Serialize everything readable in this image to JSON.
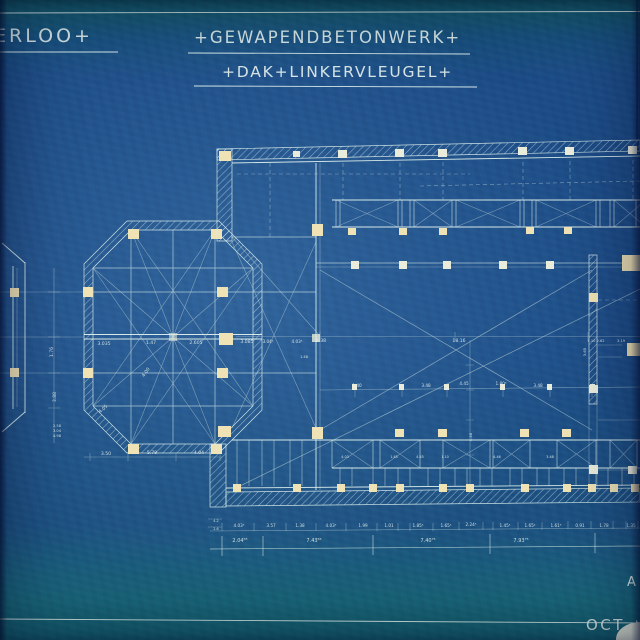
{
  "title_block": {
    "location_fragment": "ERLOO+",
    "subject": "+GEWAPENDBETONWERK+",
    "sheet": "+DAK+LINKERVLEUGEL+"
  },
  "footer": {
    "date_fragment": "OCT.+",
    "signature_fragment": "A"
  },
  "colors": {
    "paper_blue": "#1d4e88",
    "teal_edge": "#155a70",
    "ink": "#e4f1ee",
    "column_fill": "#efe2b4"
  },
  "annotations": [
    {
      "t": "3.035",
      "x": 104,
      "y": 345
    },
    {
      "t": "1.47",
      "x": 151,
      "y": 344
    },
    {
      "t": "2.605",
      "x": 196,
      "y": 344
    },
    {
      "t": "3.085",
      "x": 247,
      "y": 343
    },
    {
      "t": "4.00",
      "x": 147,
      "y": 373,
      "r": -55
    },
    {
      "t": "4.05",
      "x": 104,
      "y": 410,
      "r": -42
    },
    {
      "t": "3.50",
      "x": 106,
      "y": 455
    },
    {
      "t": "5.78",
      "x": 152,
      "y": 454
    },
    {
      "t": "4.04",
      "x": 199,
      "y": 454
    },
    {
      "t": "1.76",
      "x": 53,
      "y": 352,
      "r": -90
    },
    {
      "t": "3.88",
      "x": 56,
      "y": 397,
      "r": -90
    },
    {
      "t": "2.58",
      "x": 57,
      "y": 427,
      "s": 3.6
    },
    {
      "t": "3.04",
      "x": 57,
      "y": 432,
      "s": 3.6
    },
    {
      "t": "4.98",
      "x": 57,
      "y": 437,
      "s": 3.6
    },
    {
      "t": "3.04⁵",
      "x": 268,
      "y": 343,
      "s": 4.2
    },
    {
      "t": "4.03⁵",
      "x": 297,
      "y": 343,
      "s": 4.2
    },
    {
      "t": "8.38",
      "x": 321,
      "y": 342
    },
    {
      "t": "1.48",
      "x": 304,
      "y": 358,
      "s": 3.6
    },
    {
      "t": "18.16",
      "x": 459,
      "y": 342
    },
    {
      "t": "1.10 2.62",
      "x": 596,
      "y": 342,
      "s": 3.6
    },
    {
      "t": "3.19",
      "x": 621,
      "y": 342,
      "s": 3.6
    },
    {
      "t": "1.40",
      "x": 357,
      "y": 387,
      "s": 4.2
    },
    {
      "t": "3.48",
      "x": 426,
      "y": 387,
      "s": 4.2
    },
    {
      "t": "4.45",
      "x": 464,
      "y": 385,
      "s": 4.2
    },
    {
      "t": "1.80⁵",
      "x": 501,
      "y": 385,
      "s": 4.2
    },
    {
      "t": "3.48",
      "x": 538,
      "y": 387,
      "s": 4.2
    },
    {
      "t": "4.48",
      "x": 472,
      "y": 437,
      "r": -90,
      "s": 3.8
    },
    {
      "t": "3.65",
      "x": 586,
      "y": 352,
      "r": -90,
      "s": 3.8
    },
    {
      "t": "4.03",
      "x": 345,
      "y": 458,
      "s": 3.4
    },
    {
      "t": "1.45",
      "x": 394,
      "y": 458,
      "s": 3.4
    },
    {
      "t": "4.45",
      "x": 420,
      "y": 458,
      "s": 3.4
    },
    {
      "t": "1.10",
      "x": 445,
      "y": 458,
      "s": 3.4
    },
    {
      "t": "4.46",
      "x": 497,
      "y": 458,
      "s": 3.4
    },
    {
      "t": "3.48",
      "x": 550,
      "y": 458,
      "s": 3.4
    },
    {
      "t": "4.03⁵",
      "x": 239,
      "y": 527,
      "s": 4.2
    },
    {
      "t": "3.57",
      "x": 271,
      "y": 527,
      "s": 4.2
    },
    {
      "t": "1.38",
      "x": 300,
      "y": 527,
      "s": 4.2
    },
    {
      "t": "4.03⁵",
      "x": 331,
      "y": 527,
      "s": 4.2
    },
    {
      "t": "1.99",
      "x": 363,
      "y": 527,
      "s": 4.2
    },
    {
      "t": "1.01",
      "x": 389,
      "y": 527,
      "s": 4.2
    },
    {
      "t": "1.85⁵",
      "x": 418,
      "y": 527,
      "s": 4.2
    },
    {
      "t": "1.65⁵",
      "x": 446,
      "y": 527,
      "s": 4.2
    },
    {
      "t": "2.24⁵",
      "x": 471,
      "y": 526,
      "s": 4.2
    },
    {
      "t": "1.45⁵",
      "x": 505,
      "y": 527,
      "s": 4.2
    },
    {
      "t": "1.65²",
      "x": 530,
      "y": 527,
      "s": 4.2
    },
    {
      "t": "1.61⁵",
      "x": 556,
      "y": 527,
      "s": 4.2
    },
    {
      "t": "0.91",
      "x": 580,
      "y": 527,
      "s": 4.2
    },
    {
      "t": "1.78",
      "x": 604,
      "y": 527,
      "s": 4.2
    },
    {
      "t": "1.35",
      "x": 631,
      "y": 527,
      "s": 4.2
    },
    {
      "t": "4.2",
      "x": 216,
      "y": 522,
      "s": 3.4
    },
    {
      "t": "2.6",
      "x": 216,
      "y": 530,
      "s": 3.4
    },
    {
      "t": "2.04⁵⁵",
      "x": 240,
      "y": 542,
      "s": 5
    },
    {
      "t": "7.43⁵⁵",
      "x": 314,
      "y": 542,
      "s": 5
    },
    {
      "t": "7.40⁷⁵",
      "x": 428,
      "y": 542,
      "s": 5
    },
    {
      "t": "7.93⁷⁵",
      "x": 521,
      "y": 542,
      "s": 5
    }
  ]
}
